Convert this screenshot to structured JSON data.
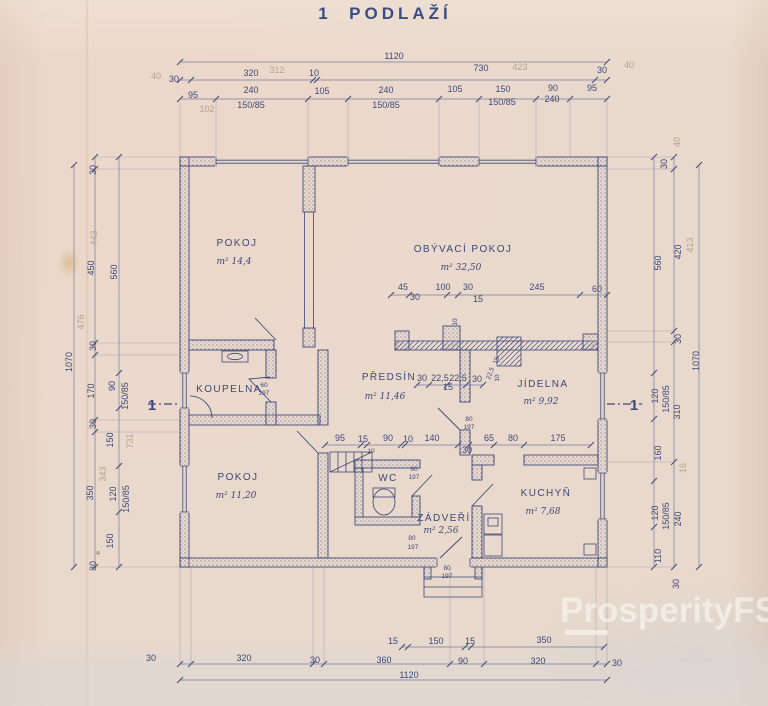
{
  "title": "1  PODLAŽÍ",
  "watermark": {
    "text": "ProsperityFS"
  },
  "colors": {
    "paper": "#e8d8cb",
    "ink": "#3e4877",
    "dim_line": "#767b9c",
    "pencil": "#b1a390",
    "title": "#3c4c80",
    "watermark": "rgba(250,248,244,0.62)"
  },
  "rooms": [
    {
      "name": "POKOJ",
      "x": 237,
      "y": 246,
      "area": "m² 14,4",
      "ax": 234,
      "ay": 264
    },
    {
      "name": "OBÝVACÍ POKOJ",
      "x": 463,
      "y": 252,
      "area": "m² 32,50",
      "ax": 461,
      "ay": 270
    },
    {
      "name": "KOUPELNA",
      "x": 229,
      "y": 392
    },
    {
      "name": "PŘEDSÍN",
      "x": 389,
      "y": 380,
      "area": "m² 11,46",
      "ax": 385,
      "ay": 399
    },
    {
      "name": "JÍDELNA",
      "x": 543,
      "y": 387,
      "area": "m² 9,92",
      "ax": 541,
      "ay": 404
    },
    {
      "name": "POKOJ",
      "x": 238,
      "y": 480,
      "area": "m² 11,20",
      "ax": 236,
      "ay": 498
    },
    {
      "name": "WC",
      "x": 388,
      "y": 481
    },
    {
      "name": "ZÁDVEŘÍ",
      "x": 444,
      "y": 521,
      "area": "m² 2,56",
      "ax": 441,
      "ay": 533
    },
    {
      "name": "KUCHYŇ",
      "x": 546,
      "y": 496,
      "area": "m² 7,68",
      "ax": 543,
      "ay": 514
    }
  ],
  "labels": [
    {
      "t": "1120",
      "x": 394,
      "y": 59
    },
    {
      "t": "30",
      "x": 174,
      "y": 82
    },
    {
      "t": "40",
      "x": 156,
      "y": 79,
      "c": "pencil"
    },
    {
      "t": "320",
      "x": 251,
      "y": 76
    },
    {
      "t": "312",
      "x": 277,
      "y": 73,
      "c": "pencil"
    },
    {
      "t": "10",
      "x": 314,
      "y": 76
    },
    {
      "t": "730",
      "x": 481,
      "y": 71
    },
    {
      "t": "423",
      "x": 520,
      "y": 70,
      "c": "pencil"
    },
    {
      "t": "30",
      "x": 602,
      "y": 73
    },
    {
      "t": "40",
      "x": 629,
      "y": 68,
      "c": "pencil"
    },
    {
      "t": "95",
      "x": 193,
      "y": 98
    },
    {
      "t": "240",
      "x": 251,
      "y": 93
    },
    {
      "t": "150/85",
      "x": 251,
      "y": 108
    },
    {
      "t": "105",
      "x": 322,
      "y": 94
    },
    {
      "t": "240",
      "x": 386,
      "y": 93
    },
    {
      "t": "150/85",
      "x": 386,
      "y": 108
    },
    {
      "t": "105",
      "x": 455,
      "y": 92
    },
    {
      "t": "150",
      "x": 503,
      "y": 92
    },
    {
      "t": "150/85",
      "x": 502,
      "y": 105
    },
    {
      "t": "90",
      "x": 553,
      "y": 91
    },
    {
      "t": "240",
      "x": 552,
      "y": 102
    },
    {
      "t": "95",
      "x": 592,
      "y": 91
    },
    {
      "t": "102",
      "x": 207,
      "y": 112,
      "c": "pencil"
    },
    {
      "t": "30",
      "x": 96,
      "y": 170,
      "r": -90
    },
    {
      "t": "450",
      "x": 94,
      "y": 268,
      "r": -90
    },
    {
      "t": "443",
      "x": 97,
      "y": 238,
      "r": -90,
      "c": "pencil"
    },
    {
      "t": "560",
      "x": 117,
      "y": 272,
      "r": -90
    },
    {
      "t": "1070",
      "x": 72,
      "y": 362,
      "r": -90
    },
    {
      "t": "476",
      "x": 84,
      "y": 322,
      "r": -90,
      "c": "pencil"
    },
    {
      "t": "30",
      "x": 96,
      "y": 346,
      "r": -90
    },
    {
      "t": "170",
      "x": 94,
      "y": 391,
      "r": -90
    },
    {
      "t": "90",
      "x": 115,
      "y": 386,
      "r": -90
    },
    {
      "t": "150/85",
      "x": 128,
      "y": 396,
      "r": -90
    },
    {
      "t": "150",
      "x": 113,
      "y": 440,
      "r": -90
    },
    {
      "t": "731",
      "x": 133,
      "y": 441,
      "r": -90,
      "c": "pencil"
    },
    {
      "t": "30",
      "x": 96,
      "y": 424,
      "r": -90
    },
    {
      "t": "350",
      "x": 93,
      "y": 493,
      "r": -90
    },
    {
      "t": "343",
      "x": 106,
      "y": 474,
      "r": -90,
      "c": "pencil"
    },
    {
      "t": "120",
      "x": 116,
      "y": 494,
      "r": -90
    },
    {
      "t": "150/85",
      "x": 129,
      "y": 499,
      "r": -90
    },
    {
      "t": "150",
      "x": 113,
      "y": 541,
      "r": -90
    },
    {
      "t": "30",
      "x": 96,
      "y": 566,
      "r": -90
    },
    {
      "t": "30",
      "x": 667,
      "y": 164,
      "r": -90
    },
    {
      "t": "40",
      "x": 680,
      "y": 142,
      "r": -90,
      "c": "pencil"
    },
    {
      "t": "560",
      "x": 661,
      "y": 263,
      "r": -90
    },
    {
      "t": "420",
      "x": 681,
      "y": 252,
      "r": -90
    },
    {
      "t": "413",
      "x": 693,
      "y": 245,
      "r": -90,
      "c": "pencil"
    },
    {
      "t": "30",
      "x": 681,
      "y": 339,
      "r": -90
    },
    {
      "t": "1070",
      "x": 699,
      "y": 361,
      "r": -90
    },
    {
      "t": "120",
      "x": 658,
      "y": 396,
      "r": -90
    },
    {
      "t": "150/85",
      "x": 669,
      "y": 399,
      "r": -90
    },
    {
      "t": "310",
      "x": 680,
      "y": 412,
      "r": -90
    },
    {
      "t": "160",
      "x": 661,
      "y": 453,
      "r": -90
    },
    {
      "t": "16",
      "x": 686,
      "y": 468,
      "r": -90,
      "c": "pencil"
    },
    {
      "t": "120",
      "x": 658,
      "y": 513,
      "r": -90
    },
    {
      "t": "150/85",
      "x": 669,
      "y": 516,
      "r": -90
    },
    {
      "t": "240",
      "x": 681,
      "y": 519,
      "r": -90
    },
    {
      "t": "110",
      "x": 661,
      "y": 556,
      "r": -90
    },
    {
      "t": "30",
      "x": 679,
      "y": 584,
      "r": -90
    },
    {
      "t": "45",
      "x": 403,
      "y": 290
    },
    {
      "t": "30",
      "x": 415,
      "y": 300
    },
    {
      "t": "100",
      "x": 443,
      "y": 290
    },
    {
      "t": "30",
      "x": 468,
      "y": 290
    },
    {
      "t": "15",
      "x": 478,
      "y": 302
    },
    {
      "t": "245",
      "x": 537,
      "y": 290
    },
    {
      "t": "60",
      "x": 597,
      "y": 292
    },
    {
      "t": "10",
      "x": 457,
      "y": 322,
      "r": -90,
      "k": "tiny"
    },
    {
      "t": "30",
      "x": 422,
      "y": 381
    },
    {
      "t": "22,5",
      "x": 440,
      "y": 381
    },
    {
      "t": "22,5",
      "x": 458,
      "y": 381
    },
    {
      "t": "30",
      "x": 477,
      "y": 382
    },
    {
      "t": "15",
      "x": 448,
      "y": 390
    },
    {
      "t": "10",
      "x": 499,
      "y": 378,
      "r": -90,
      "k": "tiny"
    },
    {
      "t": "15",
      "x": 498,
      "y": 361,
      "r": -70,
      "k": "tiny"
    },
    {
      "t": "22,5",
      "x": 492,
      "y": 374,
      "r": -70,
      "k": "tiny"
    },
    {
      "t": "95",
      "x": 340,
      "y": 441
    },
    {
      "t": "15",
      "x": 363,
      "y": 442
    },
    {
      "t": "10",
      "x": 371,
      "y": 453,
      "k": "tiny"
    },
    {
      "t": "90",
      "x": 388,
      "y": 441
    },
    {
      "t": "10",
      "x": 408,
      "y": 442
    },
    {
      "t": "140",
      "x": 432,
      "y": 441
    },
    {
      "t": "30",
      "x": 467,
      "y": 453
    },
    {
      "t": "65",
      "x": 489,
      "y": 441
    },
    {
      "t": "80",
      "x": 513,
      "y": 441
    },
    {
      "t": "175",
      "x": 558,
      "y": 441
    },
    {
      "t": "60",
      "x": 264,
      "y": 387,
      "k": "tiny"
    },
    {
      "t": "197",
      "x": 264,
      "y": 395,
      "k": "tiny"
    },
    {
      "t": "80",
      "x": 469,
      "y": 421,
      "k": "tiny"
    },
    {
      "t": "197",
      "x": 469,
      "y": 429,
      "k": "tiny"
    },
    {
      "t": "60",
      "x": 414,
      "y": 471,
      "k": "tiny"
    },
    {
      "t": "197",
      "x": 414,
      "y": 479,
      "k": "tiny"
    },
    {
      "t": "80",
      "x": 412,
      "y": 540,
      "k": "tiny"
    },
    {
      "t": "197",
      "x": 413,
      "y": 549,
      "k": "tiny"
    },
    {
      "t": "80",
      "x": 447,
      "y": 570,
      "k": "tiny"
    },
    {
      "t": "197",
      "x": 447,
      "y": 578,
      "k": "tiny"
    },
    {
      "t": "1",
      "x": 152,
      "y": 410,
      "k": "sec"
    },
    {
      "t": "1",
      "x": 634,
      "y": 410,
      "k": "sec"
    },
    {
      "t": "15",
      "x": 393,
      "y": 644
    },
    {
      "t": "150",
      "x": 436,
      "y": 644
    },
    {
      "t": "15",
      "x": 470,
      "y": 644
    },
    {
      "t": "350",
      "x": 544,
      "y": 643
    },
    {
      "t": "30",
      "x": 151,
      "y": 661
    },
    {
      "t": "320",
      "x": 244,
      "y": 661
    },
    {
      "t": "30",
      "x": 315,
      "y": 663
    },
    {
      "t": "360",
      "x": 384,
      "y": 663
    },
    {
      "t": "90",
      "x": 463,
      "y": 664
    },
    {
      "t": "320",
      "x": 538,
      "y": 664
    },
    {
      "t": "30",
      "x": 617,
      "y": 666
    },
    {
      "t": "1120",
      "x": 409,
      "y": 678
    }
  ],
  "dims": {
    "h": [
      {
        "y": 62,
        "xs": [
          180,
          607
        ]
      },
      {
        "y": 80,
        "xs": [
          180,
          191,
          313,
          317,
          595,
          607
        ]
      },
      {
        "y": 99,
        "xs": [
          180,
          216,
          308,
          348,
          439,
          479,
          536,
          570,
          607
        ],
        "w": 157
      },
      {
        "y": 295,
        "xs": [
          391,
          409,
          447,
          458,
          580,
          607
        ]
      },
      {
        "y": 385,
        "xs": [
          417,
          429,
          447,
          466,
          483
        ]
      },
      {
        "y": 445,
        "xs": [
          325,
          361,
          367,
          401,
          405,
          458,
          469,
          494,
          524,
          591
        ]
      },
      {
        "y": 647,
        "xs": [
          402,
          408,
          465,
          471,
          604
        ]
      },
      {
        "y": 664,
        "xs": [
          180,
          191,
          313,
          324,
          450,
          484,
          596,
          607
        ],
        "w": 567
      },
      {
        "y": 680,
        "xs": [
          180,
          607
        ]
      }
    ],
    "v": [
      {
        "x": 74,
        "ys": [
          165,
          567
        ]
      },
      {
        "x": 95,
        "ys": [
          157,
          169,
          343,
          355,
          420,
          432,
          567
        ],
        "w": 180
      },
      {
        "x": 119,
        "ys": [
          157,
          373,
          408,
          466,
          512,
          567
        ]
      },
      {
        "x": 654,
        "ys": [
          157,
          373,
          419,
          481,
          527,
          567
        ]
      },
      {
        "x": 674,
        "ys": [
          157,
          169,
          331,
          342,
          462,
          567
        ],
        "w": 607
      },
      {
        "x": 699,
        "ys": [
          165,
          567
        ]
      }
    ]
  }
}
